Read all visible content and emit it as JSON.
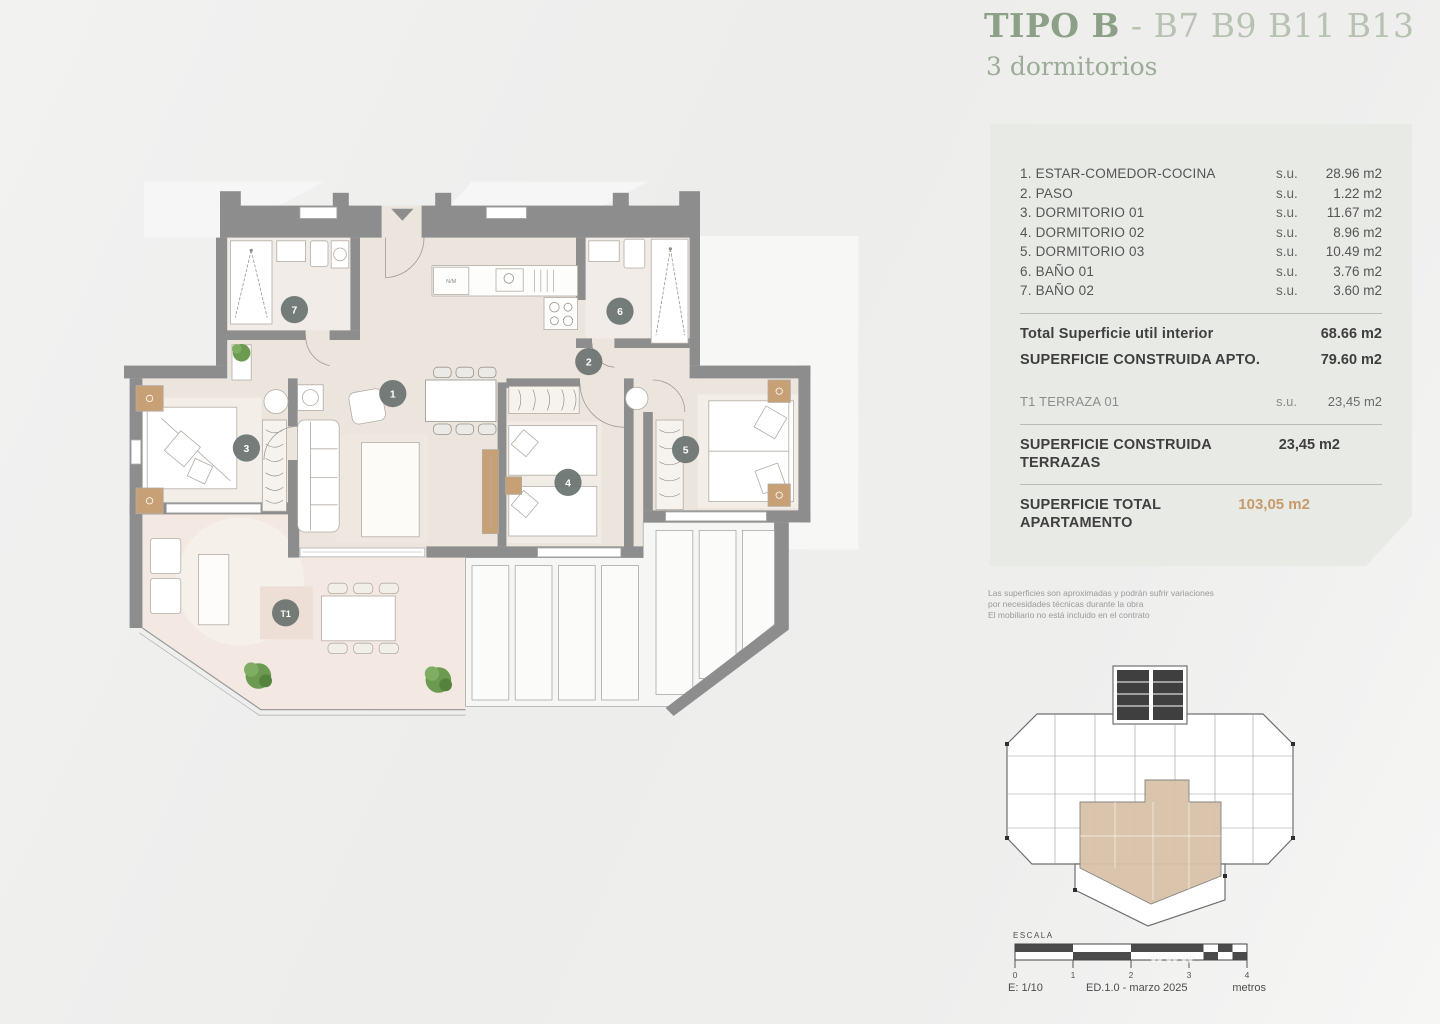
{
  "title": {
    "main": "TIPO B",
    "rest": " - B7 B9 B11 B13",
    "subtitle": "3 dormitorios"
  },
  "panel": {
    "rooms": [
      {
        "label": "1. ESTAR-COMEDOR-COCINA",
        "su": "s.u.",
        "value": "28.96 m2"
      },
      {
        "label": "2. PASO",
        "su": "s.u.",
        "value": "1.22 m2"
      },
      {
        "label": "3. DORMITORIO 01",
        "su": "s.u.",
        "value": "11.67 m2"
      },
      {
        "label": "4. DORMITORIO 02",
        "su": "s.u.",
        "value": "8.96 m2"
      },
      {
        "label": "5. DORMITORIO 03",
        "su": "s.u.",
        "value": "10.49 m2"
      },
      {
        "label": "6. BAÑO 01",
        "su": "s.u.",
        "value": "3.76 m2"
      },
      {
        "label": "7. BAÑO 02",
        "su": "s.u.",
        "value": "3.60 m2"
      }
    ],
    "total_util": {
      "label": "Total Superficie util interior",
      "value": "68.66 m2"
    },
    "construida_apto": {
      "label": "SUPERFICIE CONSTRUIDA APTO.",
      "value": "79.60 m2"
    },
    "terraza": {
      "label": "T1 TERRAZA 01",
      "su": "s.u.",
      "value": "23,45 m2"
    },
    "construida_terrazas": {
      "label": "SUPERFICIE CONSTRUIDA TERRAZAS",
      "value": "23,45 m2"
    },
    "total_apartamento": {
      "label": "SUPERFICIE TOTAL APARTAMENTO",
      "value": "103,05 m2"
    }
  },
  "disclaimer": {
    "line1": "Las superficies son aproximadas y podrán sufrir variaciones",
    "line2": "por necesidades técnicas durante la obra",
    "line3": "El mobiliario no está incluido en el contrato"
  },
  "plan": {
    "badges": {
      "b1": "1",
      "b2": "2",
      "b3": "3",
      "b4": "4",
      "b5": "5",
      "b6": "6",
      "b7": "7",
      "t1": "T1"
    },
    "kitchen_label": "N/M"
  },
  "scale": {
    "escala": "ESCALA",
    "ratio": "E: 1/10",
    "edition": "ED.1.0 - marzo 2025",
    "units_label": "metros",
    "ticks": [
      "0",
      "1",
      "2",
      "3",
      "4"
    ]
  },
  "watermark": {
    "text": "www"
  },
  "colors": {
    "accent_green": "#8ba087",
    "light_green": "#b7c2b2",
    "panel_bg": "#e8eae6",
    "orange_total": "#c89a6a",
    "wall_gray": "#8d8d8d",
    "floor_beige": "#ebe5de",
    "terrace_pink": "#f3e9e2",
    "wood_tan": "#c7a175",
    "badge": "#6b7370"
  }
}
